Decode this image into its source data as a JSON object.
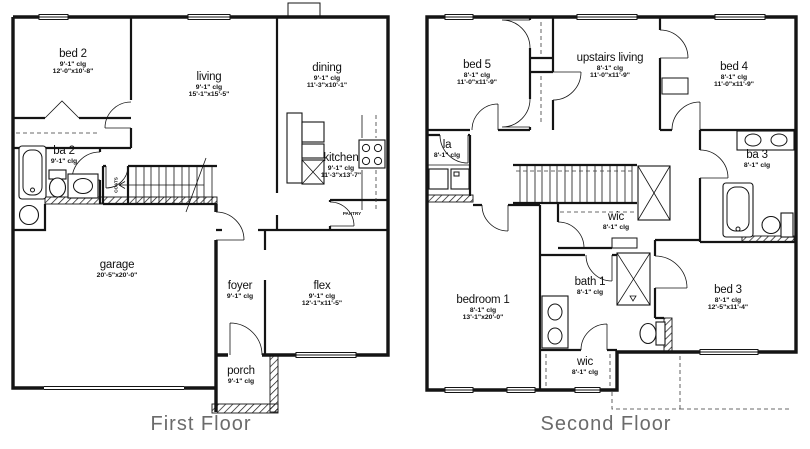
{
  "colors": {
    "background": "#ffffff",
    "lines": "#141414",
    "caption_text": "#6b6b6b"
  },
  "floors": [
    {
      "caption": "First Floor",
      "rooms": [
        {
          "name": "bed 2",
          "clg": "9'-1\" clg",
          "dims": "12'-0\"x10'-8\""
        },
        {
          "name": "living",
          "clg": "9'-1\" clg",
          "dims": "15'-1\"x15'-5\""
        },
        {
          "name": "dining",
          "clg": "9'-1\" clg",
          "dims": "11'-3\"x10'-1\""
        },
        {
          "name": "kitchen",
          "clg": "9'-1\" clg",
          "dims": "11'-3\"x13'-7\""
        },
        {
          "name": "ba 2",
          "clg": "9'-1\" clg",
          "dims": ""
        },
        {
          "name": "garage",
          "clg": "",
          "dims": "20'-5\"x20'-0\""
        },
        {
          "name": "foyer",
          "clg": "9'-1\" clg",
          "dims": ""
        },
        {
          "name": "flex",
          "clg": "9'-1\" clg",
          "dims": "12'-1\"x11'-5\""
        },
        {
          "name": "porch",
          "clg": "9'-1\" clg",
          "dims": ""
        }
      ],
      "annotations": {
        "pantry": "PANTRY",
        "coats": "COATS"
      }
    },
    {
      "caption": "Second Floor",
      "rooms": [
        {
          "name": "bed 5",
          "clg": "8'-1\" clg",
          "dims": "11'-0\"x11'-9\""
        },
        {
          "name": "upstairs living",
          "clg": "8'-1\" clg",
          "dims": "11'-0\"x11'-9\""
        },
        {
          "name": "bed 4",
          "clg": "8'-1\" clg",
          "dims": "11'-0\"x11'-9\""
        },
        {
          "name": "la",
          "clg": "8'-1\" clg",
          "dims": ""
        },
        {
          "name": "ba 3",
          "clg": "8'-1\" clg",
          "dims": ""
        },
        {
          "name": "wic",
          "clg": "8'-1\" clg",
          "dims": ""
        },
        {
          "name": "bath 1",
          "clg": "8'-1\" clg",
          "dims": ""
        },
        {
          "name": "bedroom 1",
          "clg": "8'-1\" clg",
          "dims": "13'-1\"x20'-0\""
        },
        {
          "name": "wic",
          "clg": "8'-1\" clg",
          "dims": ""
        },
        {
          "name": "bed 3",
          "clg": "8'-1\" clg",
          "dims": "12'-5\"x11'-4\""
        }
      ]
    }
  ]
}
